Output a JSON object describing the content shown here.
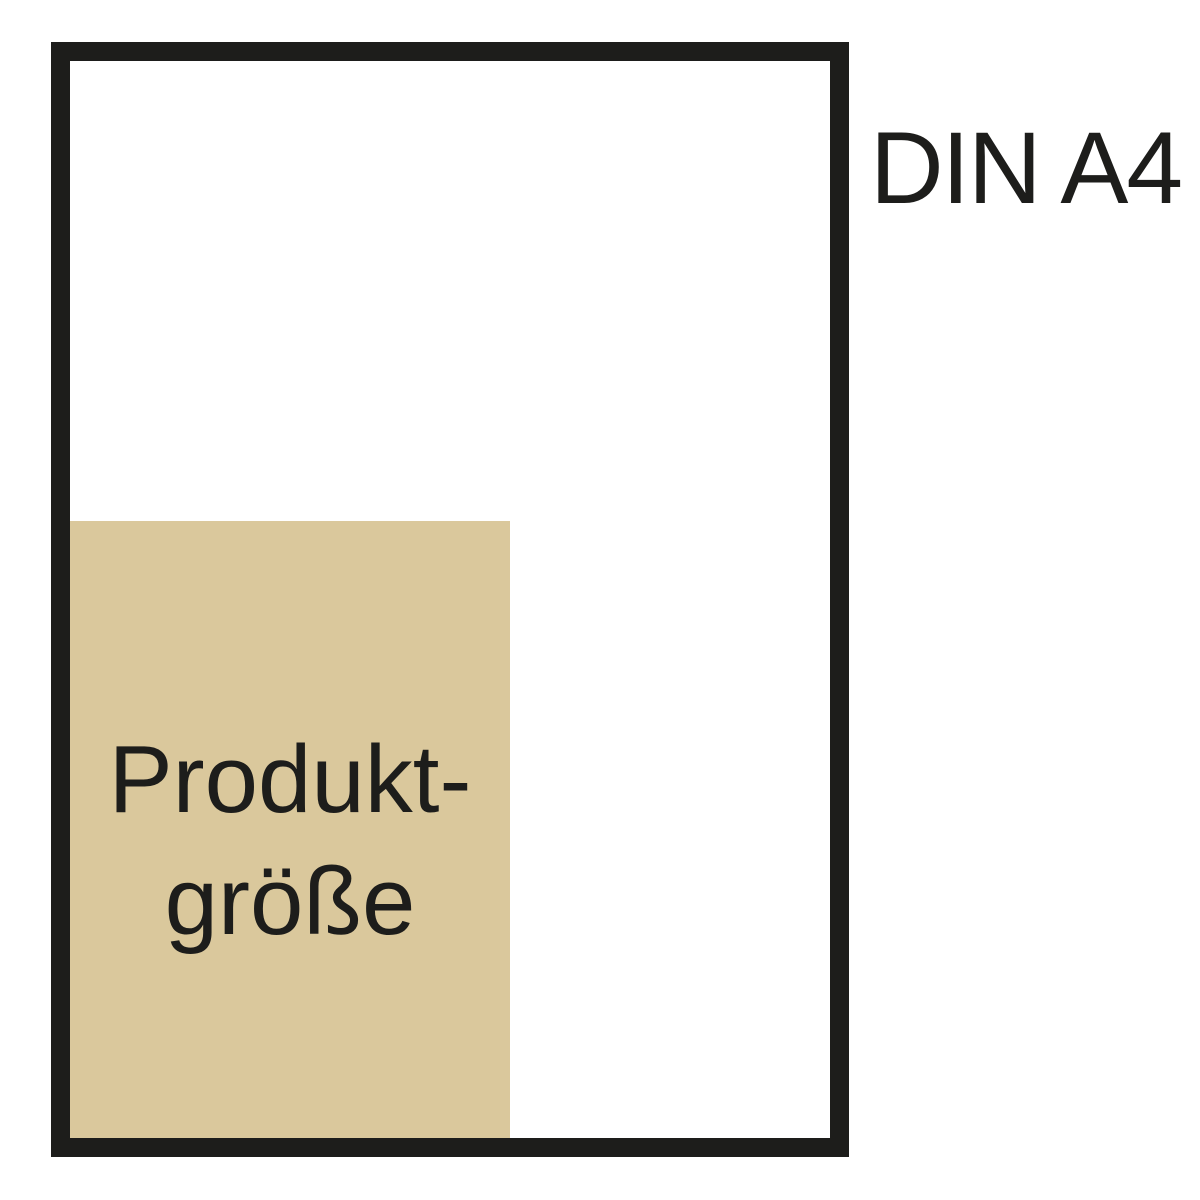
{
  "diagram": {
    "title": "Product size vs DIN A4 comparison",
    "din_label": "DIN A4",
    "product_label_line1": "Produkt-",
    "product_label_line2": "größe",
    "colors": {
      "background": "#ffffff",
      "outline": "#1d1d1b",
      "product_fill": "#dac89c",
      "text": "#1d1d1b"
    }
  }
}
